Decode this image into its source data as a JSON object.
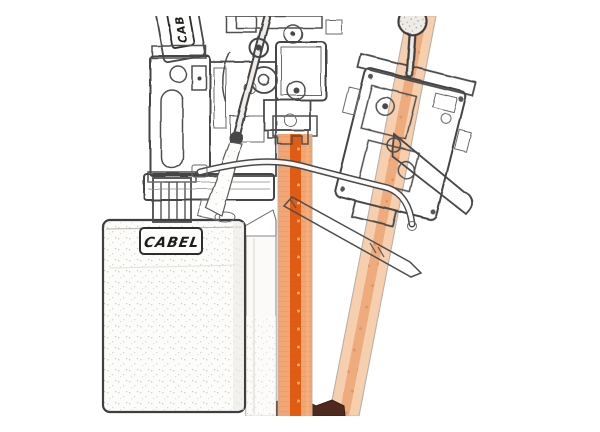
{
  "meta": {
    "description": "Pencil-sketch style product illustration: two CABEL pneumatic rock drills with hoses, a lubricator tank and two orange drill steels (one vertical, one tilted), bottom clamp in dark brown",
    "background": "#ffffff"
  },
  "branding": {
    "tank_logo": "CABEL",
    "side_logo": "CABEL"
  },
  "colors": {
    "sketch_stroke": "#4a4a4a",
    "rod_light": "#f3a675",
    "rod_stripe": "#e05c12",
    "rod_dot": "#f6b07b",
    "diag_rod_light": "#f6cfae",
    "diag_rod_stripe": "#eeab7d",
    "diag_rod_dot": "#e2925f",
    "clamp_brown": "#4e2a1e",
    "logo_text": "#1d1d1d"
  }
}
